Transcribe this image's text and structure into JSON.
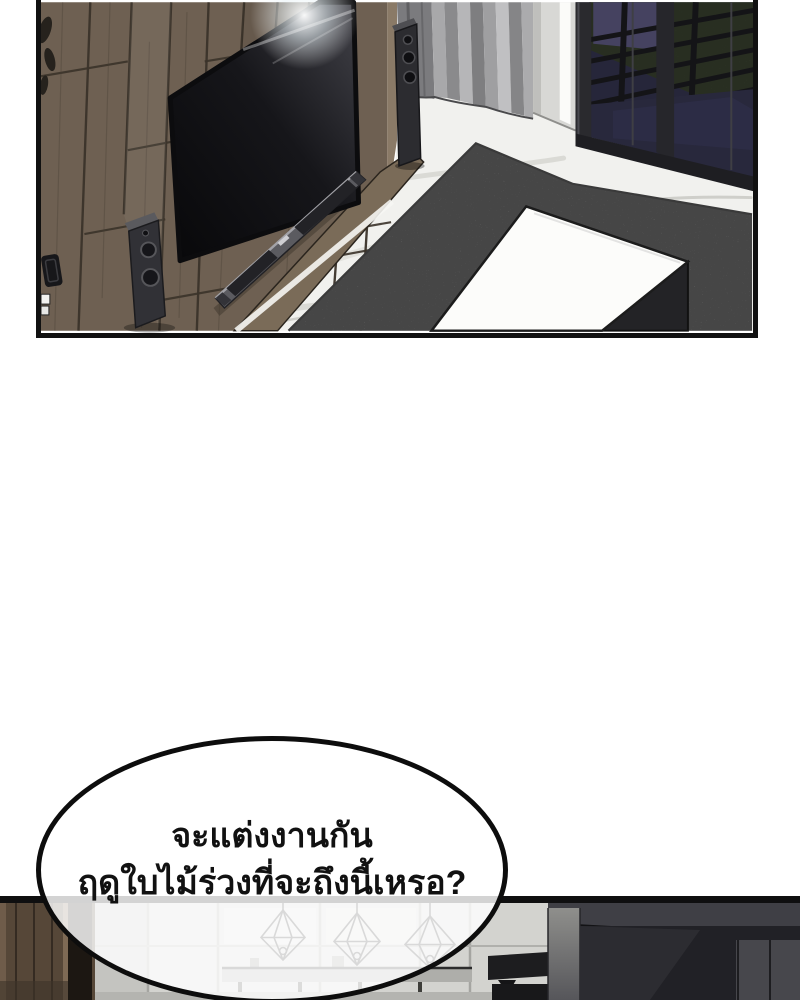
{
  "speech_bubble": {
    "line1": "จะแต่งงานกัน",
    "line2": "ฤดูใบไม้ร่วงที่จะถึงนี้เหรอ?"
  },
  "colors": {
    "page_bg": "#ffffff",
    "panel_border": "#111111",
    "text": "#111111",
    "bubble_border": "#0d0d0d",
    "wood_wall": "#6e6052",
    "wood_seam": "#3b332a",
    "wood_console": "#7a6b58",
    "tv_bezel": "#0c0c0e",
    "soundbar": "#5b5b60",
    "speaker_body": "#313136",
    "curtain": "#9a9a9c",
    "pillar": "#d8d8d5",
    "window_glass": "#26263a",
    "railing": "#141417",
    "balcony_floor": "#3e4834",
    "marble_floor": "#f1f1ee",
    "rug": "#9c9c9c",
    "table_top": "#fcfcfa",
    "kitchen_wood": "#564738",
    "kitchen_light_wall": "#d3d3cf",
    "kitchen_dark_wall": "#2c2c30",
    "pendant_line": "#2e2e2e"
  }
}
